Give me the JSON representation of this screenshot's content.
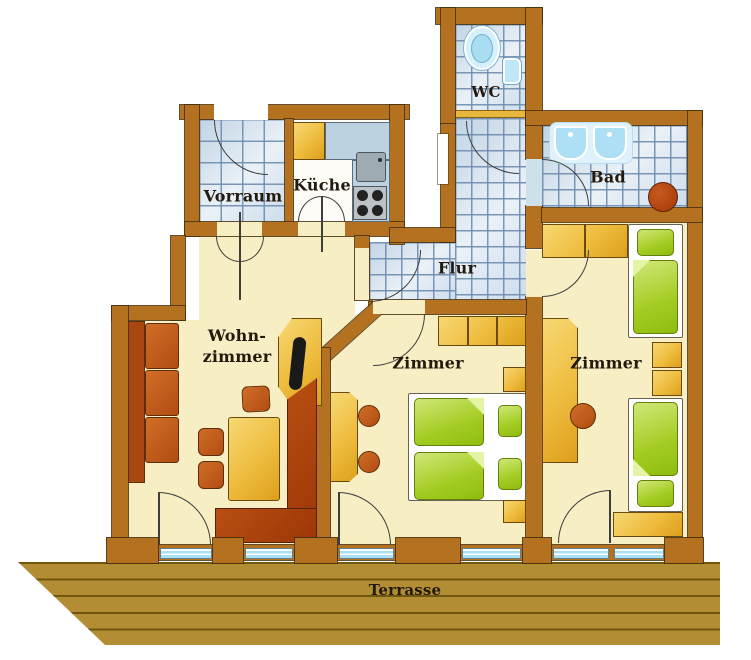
{
  "rooms": {
    "vorraum": {
      "label": "Vorraum"
    },
    "kueche": {
      "label": "Küche"
    },
    "wc": {
      "label": "WC"
    },
    "bad": {
      "label": "Bad"
    },
    "flur": {
      "label": "Flur"
    },
    "wohnzimmer": {
      "label_line1": "Wohn-",
      "label_line2": "zimmer"
    },
    "zimmer_mitte": {
      "label": "Zimmer"
    },
    "zimmer_rechts": {
      "label": "Zimmer"
    },
    "terrasse": {
      "label": "Terrasse"
    }
  },
  "colors": {
    "wall": "#b4711f",
    "room_floor": "#f8eec3",
    "tile_floor": "#d9e5f0",
    "furniture_gold": "#eebc3e",
    "furniture_rust": "#b24c12",
    "sofa_dark_red": "#9c3606",
    "bed_green": "#a3cc22",
    "window_glass": "#a9e0f3",
    "terrace_wood": "#b28d33"
  }
}
